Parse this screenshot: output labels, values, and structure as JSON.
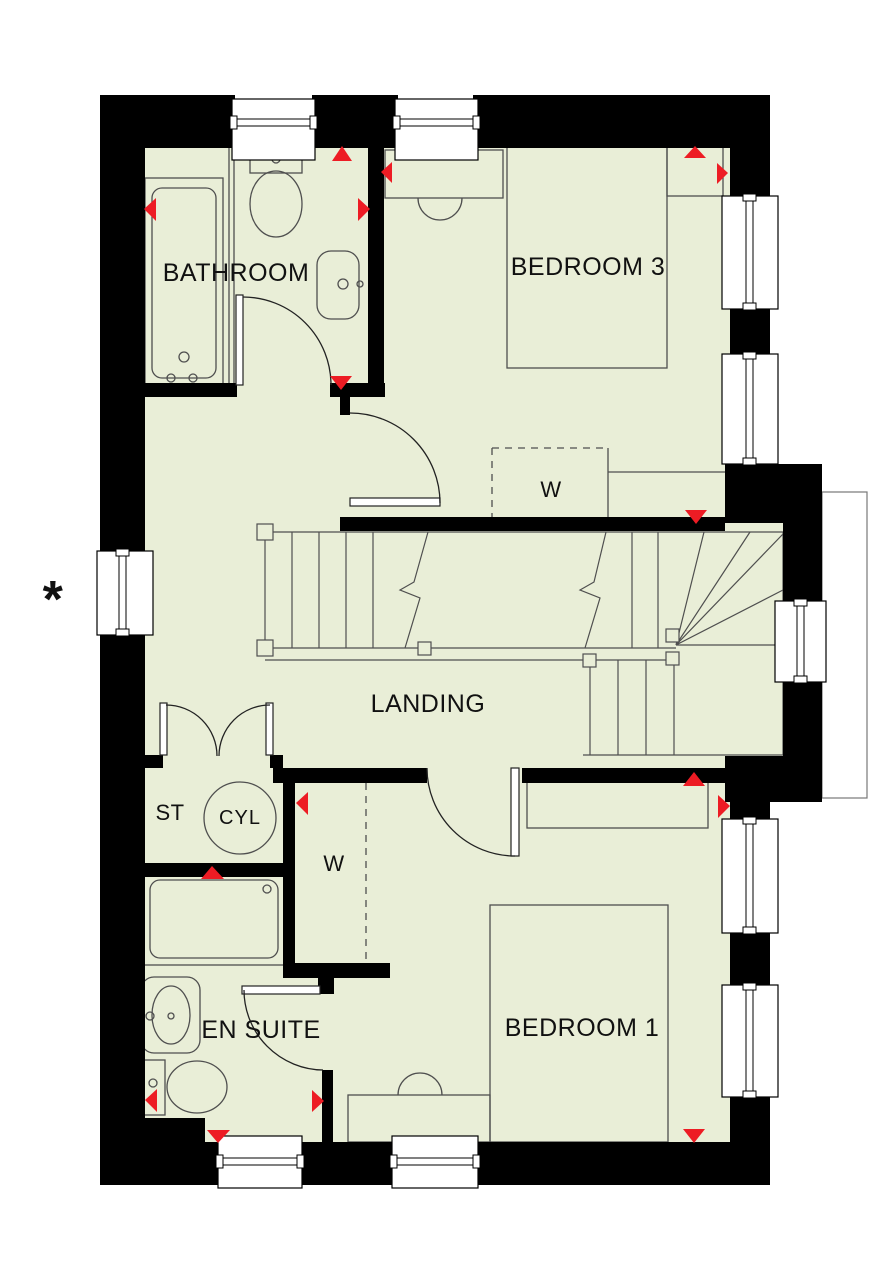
{
  "plan": {
    "rooms": {
      "bathroom": {
        "label": "BATHROOM"
      },
      "bedroom3": {
        "label": "BEDROOM 3"
      },
      "landing": {
        "label": "LANDING"
      },
      "store": {
        "label": "ST"
      },
      "cylinder": {
        "label": "CYL"
      },
      "wardrobe_bedroom3": {
        "label": "W"
      },
      "wardrobe_bedroom1": {
        "label": "W"
      },
      "ensuite": {
        "label": "EN SUITE"
      },
      "bedroom1": {
        "label": "BEDROOM 1"
      }
    },
    "markers": {
      "exterior_note": "*"
    },
    "colors": {
      "floor": "#e9eed7",
      "wall": "#000000",
      "arrow": "#ed1c24",
      "furniture_line": "#4f4f4f",
      "window_fill": "#ffffff"
    }
  }
}
